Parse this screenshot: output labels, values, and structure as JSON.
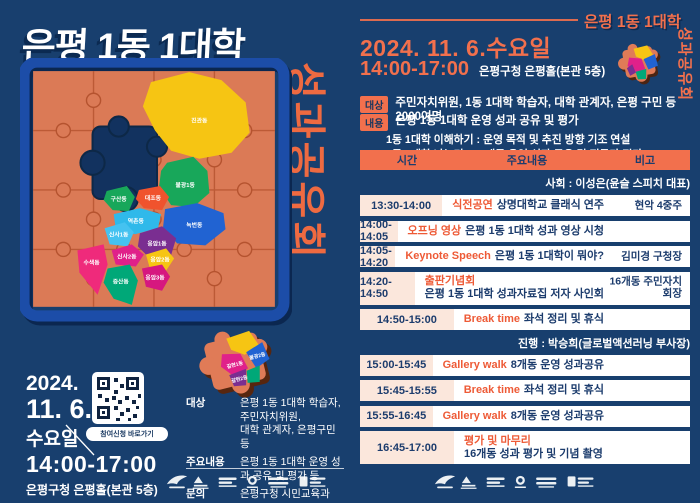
{
  "poster": {
    "title": "은평 1동 1대학",
    "vertical": "성과공유회",
    "date_year": "2024.",
    "date_day": "11. 6.",
    "date_weekday": "수요일",
    "qr_label": "참여신청 바로가기",
    "time": "14:00-17:00",
    "venue": "은평구청 은평홀(본관 5층)",
    "info_rows": [
      {
        "label": "대상",
        "line1": "은평 1동 1대학 학습자, 주민자치위원,",
        "line2": "대학 관계자, 은평구민 등"
      },
      {
        "label": "주요내용",
        "line1": "은평 1동 1대학 운영 성과 공유 및 평가 등",
        "line2": ""
      },
      {
        "label": "문의",
        "line1": "은평구청 시민교육과(02-351-7255~6)",
        "line2": ""
      }
    ],
    "map_districts": [
      {
        "name": "진관동",
        "color": "#f6c513"
      },
      {
        "name": "불광1동",
        "color": "#18a75a"
      },
      {
        "name": "구산동",
        "color": "#18a75a"
      },
      {
        "name": "대조동",
        "color": "#f0532d"
      },
      {
        "name": "역촌동",
        "color": "#2fb9ea"
      },
      {
        "name": "녹번동",
        "color": "#2163d2"
      },
      {
        "name": "신사1동",
        "color": "#45c2f0"
      },
      {
        "name": "응암1동",
        "color": "#7a2e91"
      },
      {
        "name": "신사2동",
        "color": "#e0218a"
      },
      {
        "name": "응암2동",
        "color": "#f6c513"
      },
      {
        "name": "수색동",
        "color": "#ef2a7b"
      },
      {
        "name": "증산동",
        "color": "#00a878"
      },
      {
        "name": "응암3동",
        "color": "#d6187f"
      }
    ],
    "loose_piece": [
      "갈현1동",
      "불광2동",
      "갈현2동"
    ]
  },
  "panel": {
    "badge_title": "은평 1동 1대학",
    "badge_vertical": "성과공유회",
    "date": "2024. 11. 6.수요일",
    "time": "14:00-17:00",
    "venue": "은평구청 은평홀(본관 5층)",
    "target": {
      "tag": "대상",
      "text": "주민자치위원, 1동 1대학 학습자, 대학 관계자, 은평 구민 등 2000여명"
    },
    "content": {
      "tag": "내용",
      "text": "은평 1동 1대학 운영 성과 공유 및 평가",
      "sub1": "1동 1대학 이해하기 : 운영 목적 및 추진 방향 기조 연설",
      "sub2": "1동 1대학 나누기 : 16개동 운영 성과 공유 및 전문가 평가"
    },
    "schedule": {
      "headers": [
        "시간",
        "주요내용",
        "비고"
      ],
      "mc": "사회 : 이성은(윤슬 스피치 대표)",
      "host": "진행 : 박승희(글로벌액션러닝 부사장)",
      "rows": [
        {
          "time": "13:30-14:00",
          "keyword": "식전공연",
          "text": "상명대학교 클래식 연주",
          "note": "현악 4중주"
        },
        {
          "time": "14:00-14:05",
          "keyword": "오프닝 영상",
          "text": "은평 1동 1대학 성과 영상 시청",
          "note": ""
        },
        {
          "time": "14:05-14:20",
          "keyword": "Keynote Speech",
          "text": "은평 1동 1대학이 뭐야?",
          "note": "김미경 구청장"
        },
        {
          "time": "14:20-14:50",
          "keyword": "출판기념회",
          "text": "은평 1동 1대학 성과자료집 저자 사인회",
          "note": "16개동 주민자치회장"
        },
        {
          "time": "14:50-15:00",
          "keyword": "Break time",
          "text": "좌석 정리 및 휴식",
          "note": ""
        },
        {
          "time": "15:00-15:45",
          "keyword": "Gallery walk",
          "text": "8개동 운영 성과공유",
          "note": ""
        },
        {
          "time": "15:45-15:55",
          "keyword": "Break time",
          "text": "좌석 정리 및 휴식",
          "note": ""
        },
        {
          "time": "15:55-16:45",
          "keyword": "Gallery walk",
          "text": "8개동 운영 성과공유",
          "note": ""
        },
        {
          "time": "16:45-17:00",
          "keyword": "평가 및 마무리",
          "text": "16개동 성과 평가 및 기념 촬영",
          "note": ""
        }
      ]
    }
  },
  "icons": [
    "qr-code-icon",
    "puzzle-piece-icon",
    "partner-logos"
  ],
  "colors": {
    "background": "#183f6e",
    "accent_orange": "#f2704d",
    "keyword_orange": "#ee5a36",
    "board_salmon": "#db7a56",
    "frame_blue": "#1c4da8",
    "row_time_bg": "#fbe7dc",
    "row_bg": "#ffffff",
    "text_navy": "#1c3c6d"
  }
}
